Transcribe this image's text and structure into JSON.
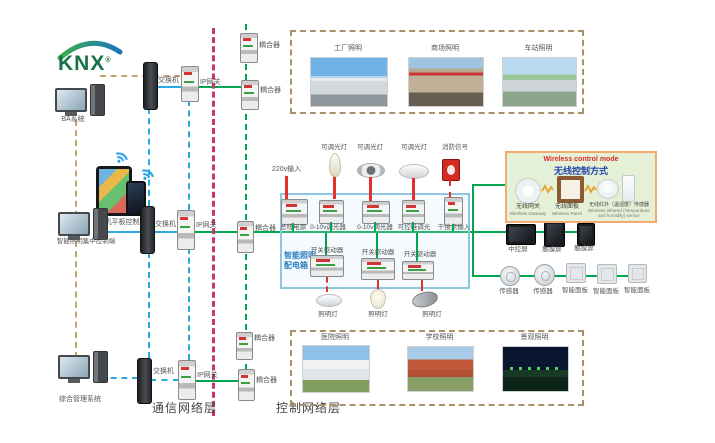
{
  "logo": {
    "text": "KNX"
  },
  "left": {
    "computers": [
      {
        "label": "BA系统"
      },
      {
        "label": "智能照明集中控制端"
      },
      {
        "label": "综合管理系统"
      }
    ],
    "mobile_label": "手机平板控制端"
  },
  "network": {
    "switch_label": "交换机",
    "gateway_label": "IP网关",
    "coupler_label": "耦合器",
    "comm_layer_label": "通信网络层",
    "ctrl_layer_label": "控制网络层"
  },
  "top_apps": {
    "captions": [
      "工厂照明",
      "商场照明",
      "车站照明"
    ]
  },
  "bottom_apps": {
    "captions": [
      "医院照明",
      "学校照明",
      "景观照明"
    ]
  },
  "cabinet": {
    "title_line1": "智能照明",
    "title_line2": "配电箱",
    "input_label": "220v输入",
    "top_loads": [
      "可调光灯",
      "可调光灯",
      "可调光灯",
      "消防信号"
    ],
    "row1_devices": [
      "总线电源",
      "0-10v调光器",
      "0-10v调光器",
      "可控硅调光",
      "干接点输入"
    ],
    "row2_devices": [
      "开关驱动器",
      "开关驱动器",
      "开关驱动器"
    ],
    "bottom_loads": [
      "照明灯",
      "照明灯",
      "照明灯"
    ]
  },
  "right_bus": {
    "screens": [
      "中控屏",
      "触摸屏",
      "触摸屏"
    ],
    "devices": [
      "传感器",
      "传感器",
      "智能面板",
      "智能面板",
      "智能面板"
    ]
  },
  "wireless": {
    "title_en": "Wireless control mode",
    "title_zh": "无线控制方式",
    "items": [
      {
        "zh": "无线网关",
        "en": "Wireless Gateway"
      },
      {
        "zh": "无线面板",
        "en": "Wireless Panel"
      },
      {
        "zh": "无线红外（温湿度）传感器",
        "en": "Wireless infrared (Temperature and humidity) sensor"
      }
    ]
  },
  "colors": {
    "bus_green": "#00a651",
    "lan_blue": "#29abe2",
    "layer_divider_magenta": "#c9366f",
    "power_red": "#e53030",
    "legacy_khaki": "#bfa76a"
  }
}
